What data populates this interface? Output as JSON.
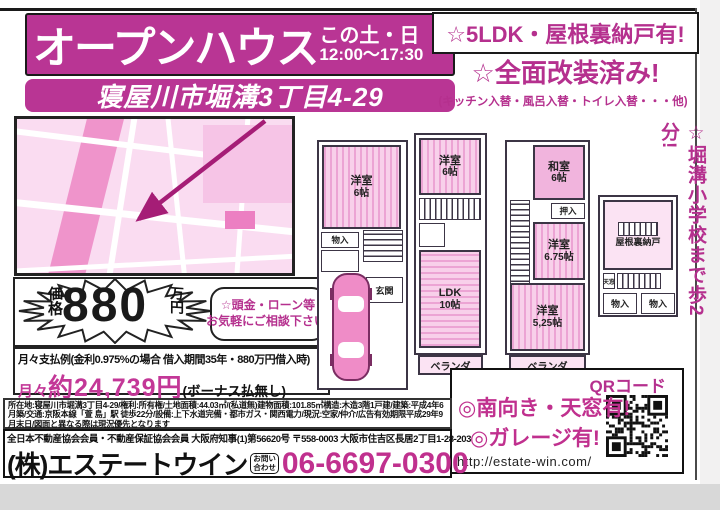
{
  "colors": {
    "magenta": "#b93594",
    "text_magenta": "#b5308e",
    "phone_magenta": "#c0308e",
    "map_pink": "#fadcf1",
    "room_pink": "#f8d0ea",
    "scan_gray": "#d8d8d8"
  },
  "header": {
    "title": "オープンハウス",
    "date_label": "この土・日",
    "time": "12:00〜17:30",
    "address": "寝屋川市堀溝3丁目4-29"
  },
  "features": {
    "line1": "☆5LDK・屋根裏納戸有!",
    "line2": "☆全面改装済み!",
    "line3": "(キッチン入替・風呂入替・トイレ入替・・・他)",
    "side_note": "☆堀溝小学校まで歩2分!"
  },
  "price": {
    "label": "価格",
    "amount": "880",
    "unit": "万円",
    "bubble_line1": "☆頭金・ローン等",
    "bubble_line2": "お気軽にご相談下さい!"
  },
  "payment": {
    "example": "月々支払例(金利0.975%の場合 借入期間35年・880万円借入時)",
    "monthly_prefix": "月々",
    "monthly_amount": "約24,739円",
    "monthly_suffix": "(ボーナス払無し)"
  },
  "floorplans": {
    "plan1": {
      "room1_name": "洋室",
      "room1_size": "6帖",
      "closet": "物入",
      "entrance": "玄関"
    },
    "plan2": {
      "room1_name": "洋室",
      "room1_size": "6帖",
      "ldk_name": "LDK",
      "ldk_size": "10帖",
      "balcony": "ベランダ"
    },
    "plan3": {
      "room1_name": "和室",
      "room1_size": "6帖",
      "closet": "押入",
      "room2_name": "洋室",
      "room2_size": "6.75帖",
      "room3_name": "洋室",
      "room3_size": "5,25帖",
      "balcony": "ベランダ"
    },
    "attic": {
      "name": "屋根裏納戸",
      "skylight": "天窓",
      "closet1": "物入",
      "closet2": "物入"
    }
  },
  "promo": {
    "south": "◎南向き・天窓有!",
    "garage": "◎ガレージ有!",
    "url": "http://estate-win.com/",
    "qr_label": "QRコード"
  },
  "legal": {
    "details": "所在地:寝屋川市堀溝3丁目4-29/権利:所有権/土地面積:44.03㎡/(私道無)建物面積:101.85㎡構造:木造3階1戸建/建築:平成4年6月築/交通:京阪本線「萱 島」駅 徒歩22分/設備:上下水道完備・都市ガス・関西電力/現況:空家/仲介/広告有効期限平成29年9月末日/図面と異なる際は現況優先となります",
    "license": "全日本不動産協会会員・不動産保証協会会員 大阪府知事(1)第56620号 〒558-0003 大阪市住吉区長居2丁目1-28-203"
  },
  "company": {
    "name": "(株)エステートウイン",
    "contact_badge_line1": "お問い",
    "contact_badge_line2": "合わせ",
    "phone": "06-6697-0300"
  }
}
